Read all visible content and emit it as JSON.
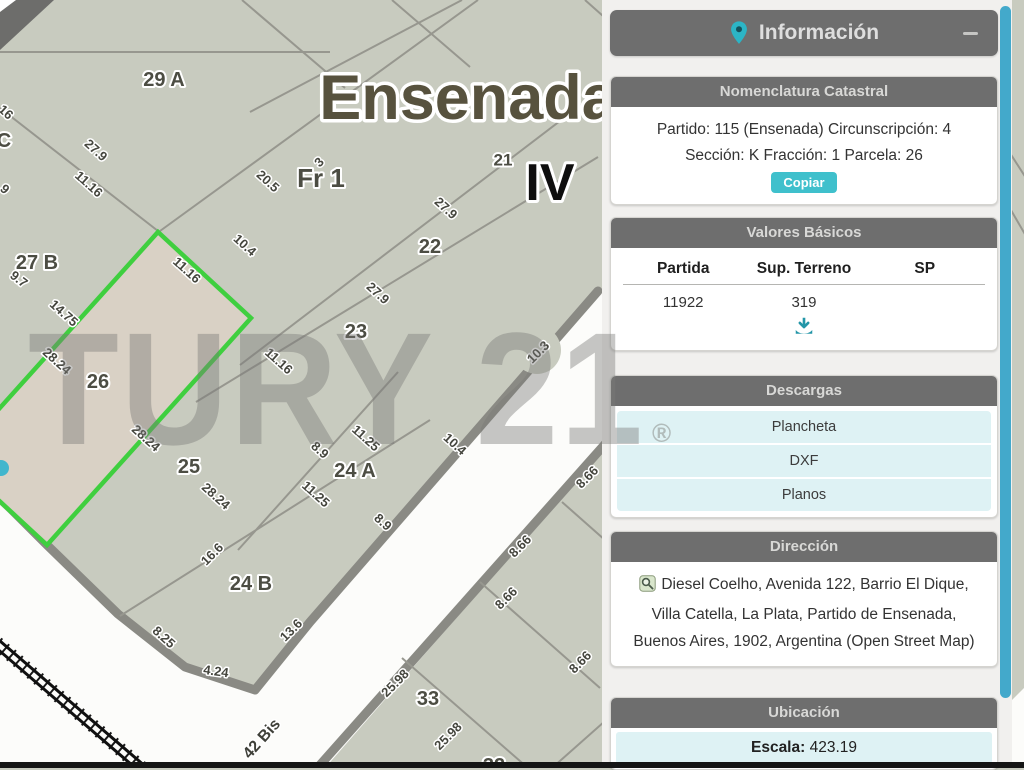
{
  "panel": {
    "info_title": "Información",
    "nomenclatura": {
      "header": "Nomenclatura Catastral",
      "line1": "Partido: 115 (Ensenada) Circunscripción: 4",
      "line2": "Sección: K Fracción: 1 Parcela: 26",
      "copy": "Copiar"
    },
    "valores": {
      "header": "Valores Básicos",
      "columns": [
        "Partida",
        "Sup. Terreno",
        "SP"
      ],
      "row": {
        "partida": "11922",
        "sup_terreno": "319",
        "sp": ""
      }
    },
    "descargas": {
      "header": "Descargas",
      "items": [
        "Plancheta",
        "DXF",
        "Planos"
      ]
    },
    "direccion": {
      "header": "Dirección",
      "text": "Diesel Coelho, Avenida 122, Barrio El Dique, Villa Catella, La Plata, Partido de Ensenada, Buenos Aires, 1902, Argentina (Open Street Map)"
    },
    "ubicacion": {
      "header": "Ubicación",
      "escala_label": "Escala:",
      "escala_value": "423.19"
    }
  },
  "watermark": {
    "text": "TURY 21",
    "reg": "®"
  },
  "map": {
    "region_label": "Ensenada",
    "zone_label": "IV",
    "fraction_label": "Fr 1",
    "selected_parcel": "26",
    "parcel_labels": [
      {
        "text": "Ensenada",
        "x": 468,
        "y": 98,
        "size": 63,
        "cls": "title"
      },
      {
        "text": "IV",
        "x": 550,
        "y": 183,
        "size": 52,
        "cls": "zone"
      },
      {
        "text": "Fr 1",
        "x": 321,
        "y": 178,
        "size": 26
      },
      {
        "text": "29 A",
        "x": 164,
        "y": 80,
        "size": 20
      },
      {
        "text": "21",
        "x": 503,
        "y": 160,
        "size": 17
      },
      {
        "text": "22",
        "x": 430,
        "y": 247,
        "size": 20
      },
      {
        "text": "23",
        "x": 356,
        "y": 332,
        "size": 20
      },
      {
        "text": "27 B",
        "x": 37,
        "y": 263,
        "size": 20
      },
      {
        "text": "C",
        "x": 4,
        "y": 141,
        "size": 20
      },
      {
        "text": "26",
        "x": 98,
        "y": 382,
        "size": 20
      },
      {
        "text": "25",
        "x": 189,
        "y": 467,
        "size": 20
      },
      {
        "text": "24 A",
        "x": 355,
        "y": 471,
        "size": 20
      },
      {
        "text": "24 B",
        "x": 251,
        "y": 584,
        "size": 20
      },
      {
        "text": "33",
        "x": 428,
        "y": 699,
        "size": 20
      },
      {
        "text": "32",
        "x": 494,
        "y": 766,
        "size": 20
      }
    ],
    "dim_labels": [
      {
        "text": "16",
        "x": 6,
        "y": 112,
        "r": 42
      },
      {
        "text": "9",
        "x": 5,
        "y": 189,
        "r": 42
      },
      {
        "text": "27.9",
        "x": 96,
        "y": 150,
        "r": 42
      },
      {
        "text": "11.16",
        "x": 89,
        "y": 184,
        "r": 42
      },
      {
        "text": "20.5",
        "x": 268,
        "y": 181,
        "r": 42
      },
      {
        "text": "10.4",
        "x": 245,
        "y": 245,
        "r": 42
      },
      {
        "text": "3",
        "x": 319,
        "y": 162,
        "r": -45
      },
      {
        "text": "27.9",
        "x": 446,
        "y": 208,
        "r": 42
      },
      {
        "text": "27.9",
        "x": 378,
        "y": 293,
        "r": 42
      },
      {
        "text": "10.3",
        "x": 538,
        "y": 352,
        "r": -45
      },
      {
        "text": "9.7",
        "x": 19,
        "y": 279,
        "r": 38
      },
      {
        "text": "14.75",
        "x": 64,
        "y": 313,
        "r": 42
      },
      {
        "text": "28.24",
        "x": 57,
        "y": 361,
        "r": 42
      },
      {
        "text": "11.16",
        "x": 187,
        "y": 270,
        "r": 42
      },
      {
        "text": "11.16",
        "x": 279,
        "y": 361,
        "r": 42
      },
      {
        "text": "28.24",
        "x": 146,
        "y": 438,
        "r": 42
      },
      {
        "text": "28.24",
        "x": 216,
        "y": 496,
        "r": 42
      },
      {
        "text": "11.25",
        "x": 366,
        "y": 438,
        "r": 42
      },
      {
        "text": "10.4",
        "x": 455,
        "y": 444,
        "r": 42
      },
      {
        "text": "8.9",
        "x": 320,
        "y": 450,
        "r": 42
      },
      {
        "text": "11.25",
        "x": 316,
        "y": 494,
        "r": 42
      },
      {
        "text": "8.9",
        "x": 383,
        "y": 522,
        "r": 42
      },
      {
        "text": "16.6",
        "x": 212,
        "y": 554,
        "r": -45
      },
      {
        "text": "8.25",
        "x": 164,
        "y": 637,
        "r": 42
      },
      {
        "text": "4.24",
        "x": 216,
        "y": 671,
        "r": 8
      },
      {
        "text": "13.6",
        "x": 291,
        "y": 630,
        "r": -45
      },
      {
        "text": "8.66",
        "x": 587,
        "y": 477,
        "r": -45
      },
      {
        "text": "8.66",
        "x": 520,
        "y": 546,
        "r": -45
      },
      {
        "text": "8.66",
        "x": 506,
        "y": 598,
        "r": -45
      },
      {
        "text": "8.66",
        "x": 580,
        "y": 662,
        "r": -45
      },
      {
        "text": "25.98",
        "x": 395,
        "y": 683,
        "r": -45
      },
      {
        "text": "25.98",
        "x": 448,
        "y": 736,
        "r": -45
      },
      {
        "text": "42 Bis",
        "x": 262,
        "y": 739,
        "r": -48,
        "cls": "street"
      }
    ]
  },
  "colors": {
    "accent_teal": "#3fc0cc",
    "header_gray": "#6e6e6e",
    "row_teal": "#def2f4",
    "scrollbar_blue": "#43a9cb",
    "parcel_green": "#3fcf3f",
    "selected_parcel_fill": "#d9d1c5",
    "map_background": "#c8cbbf"
  }
}
